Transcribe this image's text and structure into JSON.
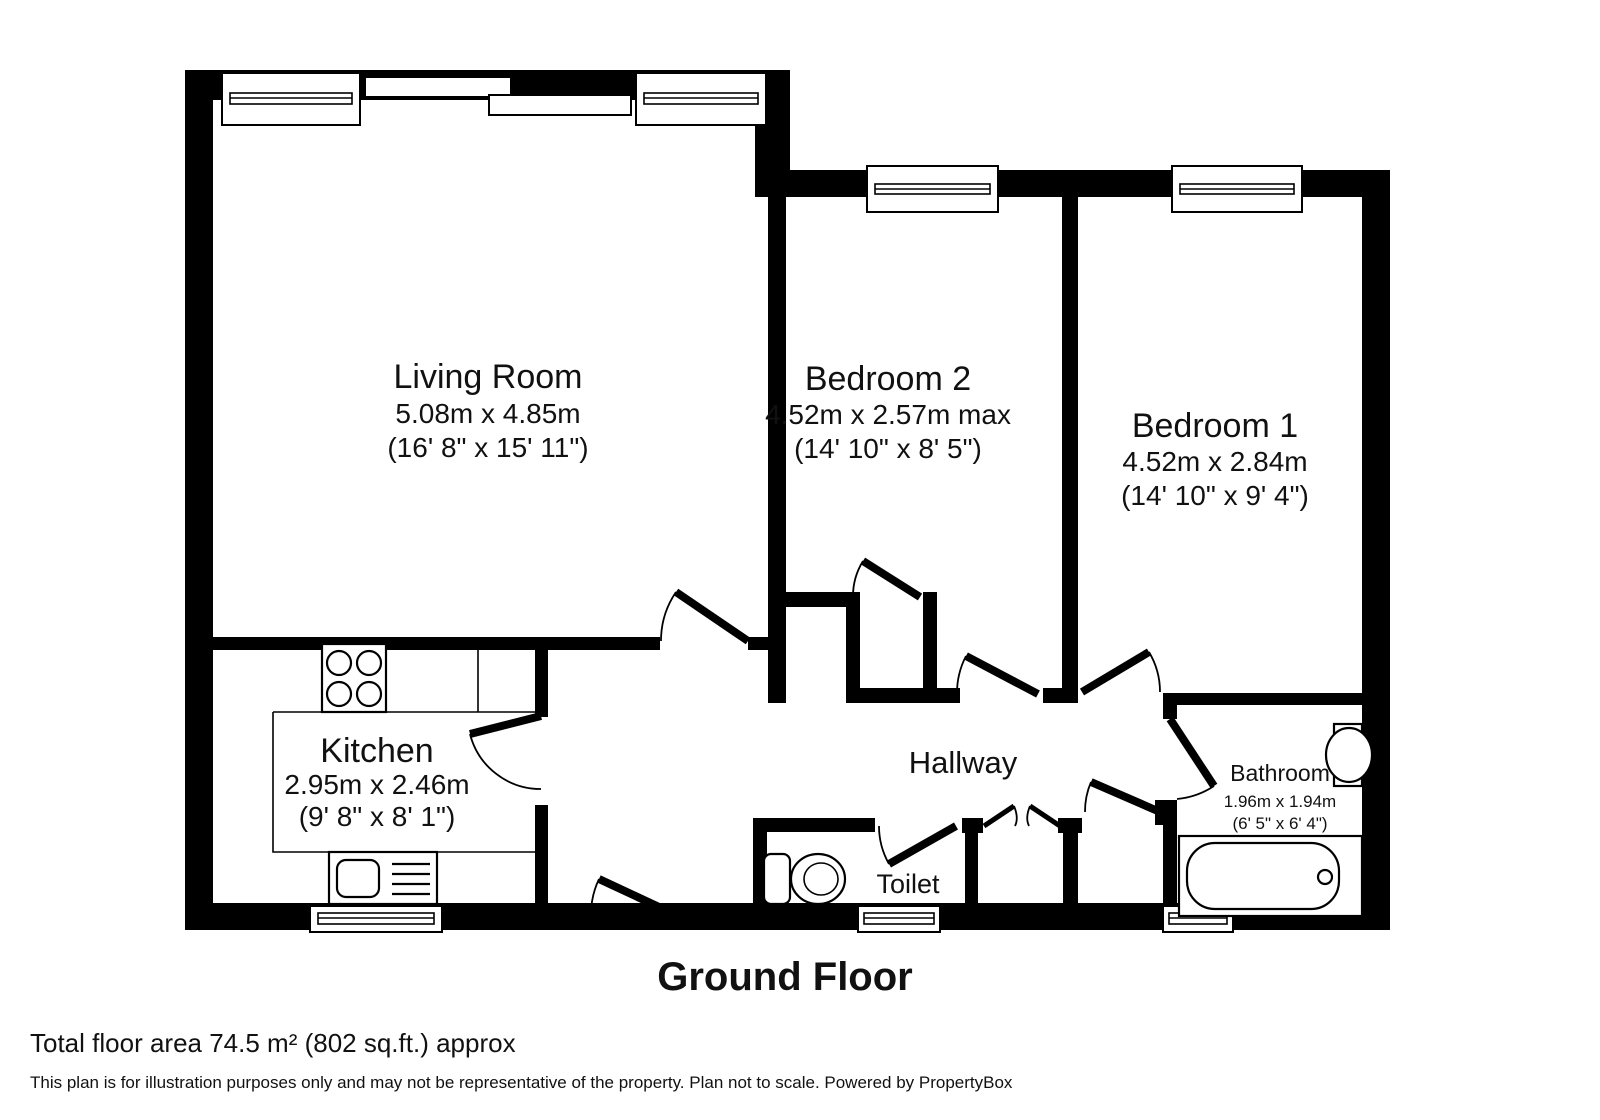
{
  "title": "Ground Floor",
  "footer": {
    "total_area": "Total floor area 74.5 m² (802 sq.ft.) approx",
    "disclaimer": "This plan is for illustration purposes only and may not be representative of the property. Plan not to scale. Powered by PropertyBox"
  },
  "rooms": {
    "living_room": {
      "name": "Living Room",
      "dims_m": "5.08m x 4.85m",
      "dims_ft": "(16' 8\" x 15' 11\")"
    },
    "bedroom2": {
      "name": "Bedroom 2",
      "dims_m": "4.52m x 2.57m max",
      "dims_ft": "(14' 10\" x 8' 5\")"
    },
    "bedroom1": {
      "name": "Bedroom 1",
      "dims_m": "4.52m x 2.84m",
      "dims_ft": "(14' 10\" x 9' 4\")"
    },
    "kitchen": {
      "name": "Kitchen",
      "dims_m": "2.95m x 2.46m",
      "dims_ft": "(9' 8\" x 8' 1\")"
    },
    "hallway": {
      "name": "Hallway"
    },
    "toilet": {
      "name": "Toilet"
    },
    "bathroom": {
      "name": "Bathroom",
      "dims_m": "1.96m x 1.94m",
      "dims_ft": "(6' 5\" x 6' 4\")"
    }
  },
  "colors": {
    "wall": "#000000",
    "background": "#ffffff",
    "text": "#111111"
  }
}
